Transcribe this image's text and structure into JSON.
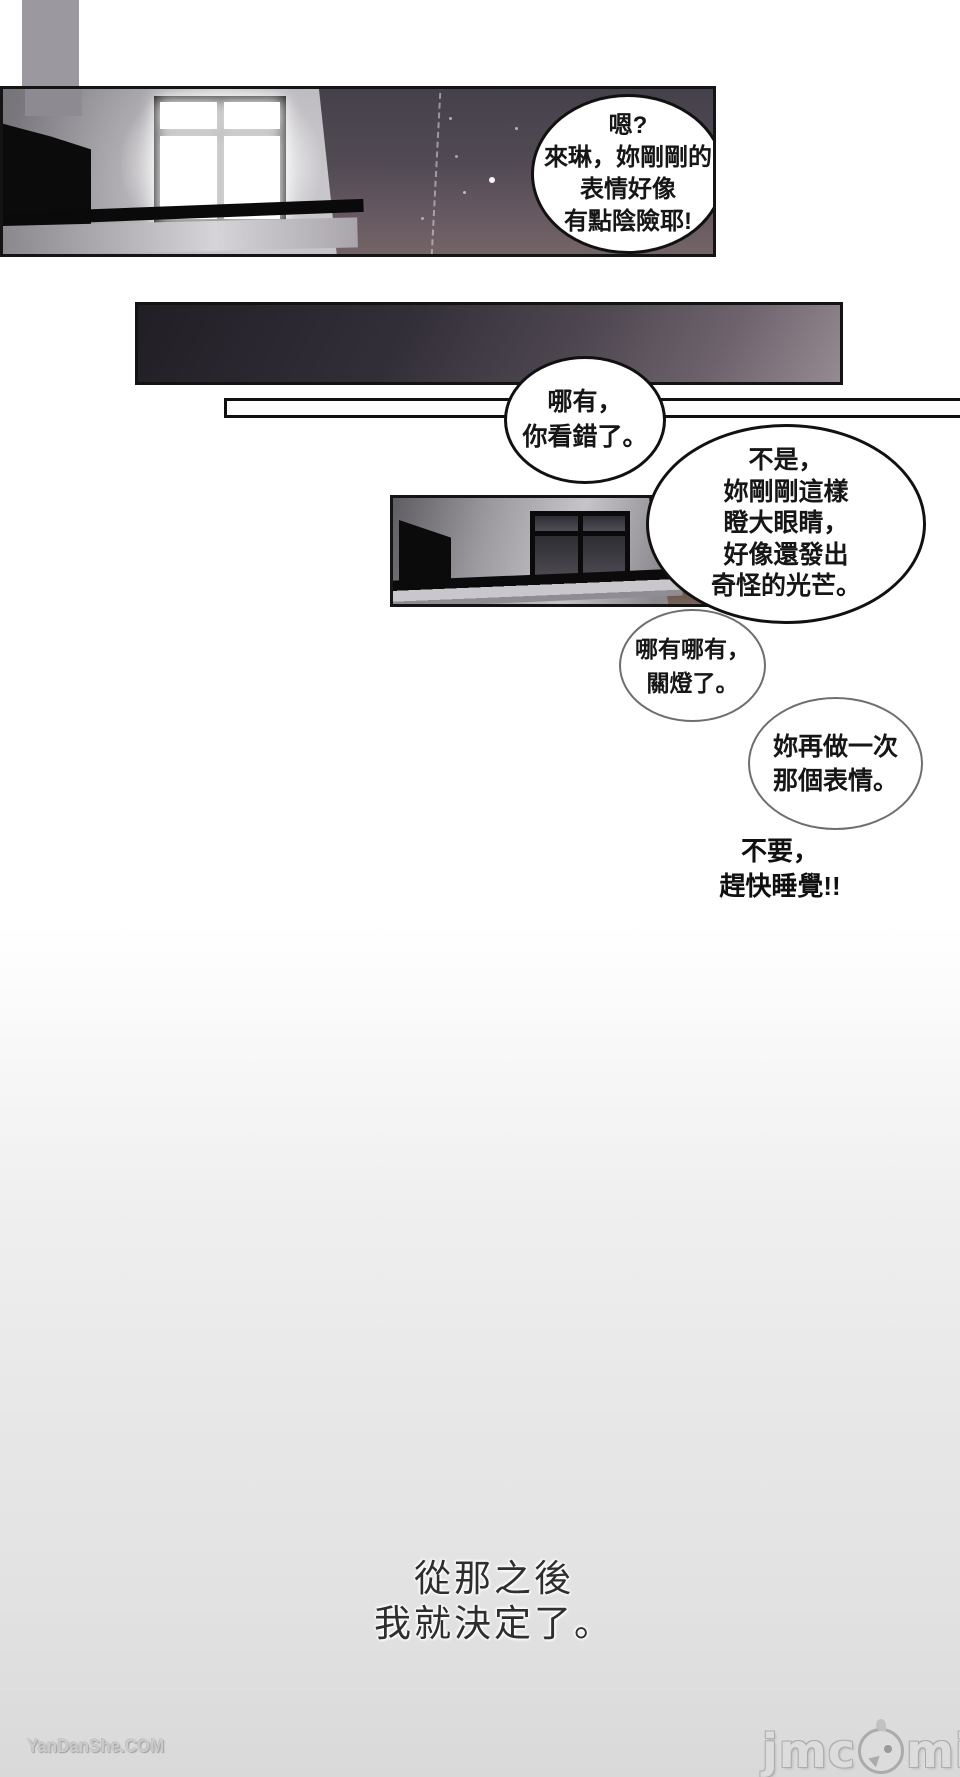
{
  "speech": {
    "b1": [
      "嗯?",
      "來琳，妳剛剛的",
      "表情好像",
      "有點陰險耶!"
    ],
    "b2": [
      "哪有，",
      "你看錯了。"
    ],
    "b3": [
      "不是，",
      "妳剛剛這樣",
      "瞪大眼睛，",
      "好像還發出",
      "奇怪的光芒。"
    ],
    "b4": [
      "哪有哪有，",
      "關燈了。"
    ],
    "b5": [
      "妳再做一次",
      "那個表情。"
    ],
    "shout": [
      "不要，",
      "趕快睡覺!!"
    ],
    "caption": [
      "從那之後",
      "我就決定了。"
    ]
  },
  "watermarks": {
    "site": "YanDanShe.COM",
    "logo_prefix": "jmc",
    "logo_suffix": "mic"
  },
  "colors": {
    "panel_border": "#141414",
    "bubble_border_dark": "#111111",
    "bubble_border_light": "#6e6e6e",
    "night_sky_top": "#45414b",
    "night_sky_bottom": "#736466",
    "strip_dark": "#211e25",
    "strip_light": "#968a92",
    "caption_text": "#2e2e2e",
    "watermark_text": "#cbcbcb",
    "logo_text": "#dcdcdc",
    "page_bottom": "#d9d9d9"
  }
}
